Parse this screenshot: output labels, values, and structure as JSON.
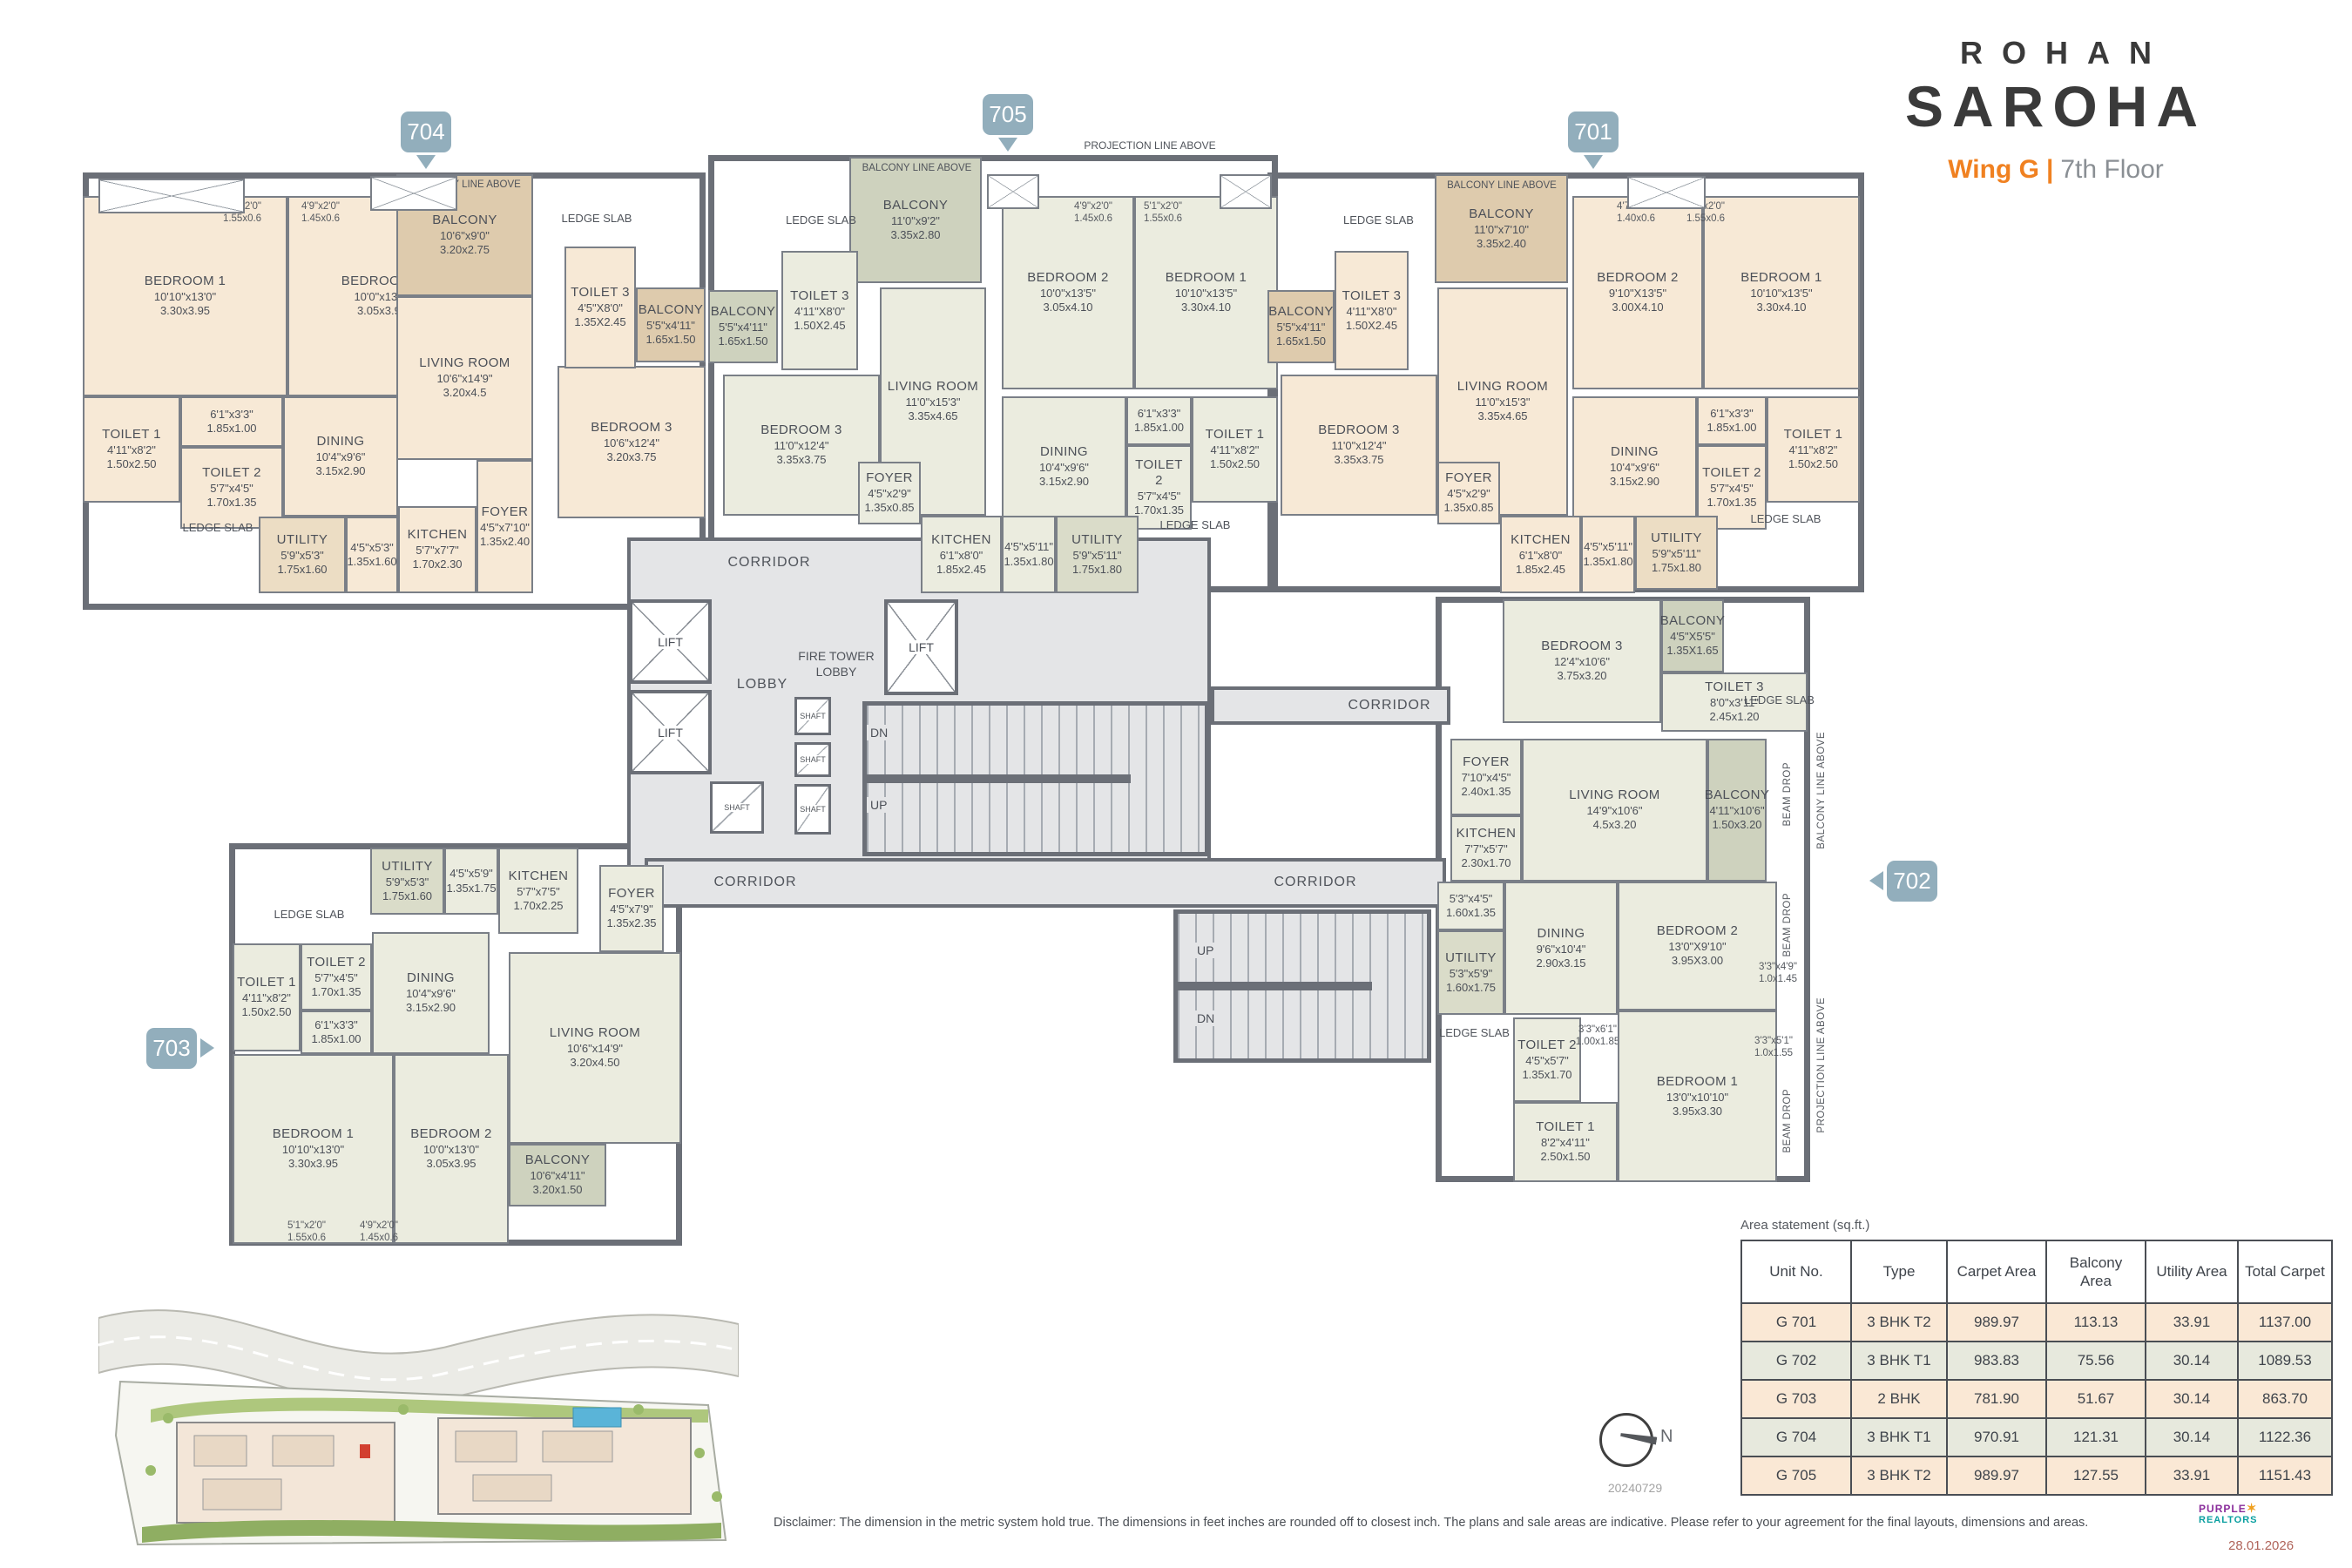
{
  "brand": {
    "line1": "ROHAN",
    "line2": "SAROHA",
    "wing": "Wing G",
    "sep": "|",
    "floor": "7th Floor"
  },
  "colors": {
    "accent": "#f08121",
    "badge": "#92aebc",
    "wall": "#6b6f77",
    "peach": "#f7e9d6",
    "sage": "#ebecdf",
    "tan": "#decbad",
    "corridor": "#e4e5e7",
    "table_row_peach": "#fae8d5",
    "table_row_sage": "#e7e9dd"
  },
  "badges": {
    "u701": "701",
    "u702": "702",
    "u703": "703",
    "u704": "704",
    "u705": "705"
  },
  "labels": {
    "corridor": "CORRIDOR",
    "lobby": "LOBBY",
    "fire_tower_lobby": "FIRE TOWER LOBBY",
    "lift": "LIFT",
    "shaft": "SHAFT",
    "dn": "DN",
    "up": "UP",
    "ledge_slab": "LEDGE SLAB",
    "balcony_line_above": "BALCONY LINE ABOVE",
    "projection_line_above": "PROJECTION LINE ABOVE",
    "beam_drop": "BEAM DROP"
  },
  "rooms": {
    "u704": [
      {
        "name": "BEDROOM 1",
        "ft": "10'10\"x13'0\"",
        "m": "3.30x3.95"
      },
      {
        "name": "BEDROOM 2",
        "ft": "10'0\"x13'0\"",
        "m": "3.05x3.95"
      },
      {
        "name": "BALCONY",
        "ft": "10'6\"x9'0\"",
        "m": "3.20x2.75"
      },
      {
        "name": "LIVING ROOM",
        "ft": "10'6\"x14'9\"",
        "m": "3.20x4.5"
      },
      {
        "name": "TOILET 1",
        "ft": "4'11\"x8'2\"",
        "m": "1.50x2.50"
      },
      {
        "ft": "6'1\"x3'3\"",
        "m": "1.85x1.00"
      },
      {
        "name": "TOILET 2",
        "ft": "5'7\"x4'5\"",
        "m": "1.70x1.35"
      },
      {
        "name": "DINING",
        "ft": "10'4\"x9'6\"",
        "m": "3.15x2.90"
      },
      {
        "name": "UTILITY",
        "ft": "5'9\"x5'3\"",
        "m": "1.75x1.60"
      },
      {
        "ft": "4'5\"x5'3\"",
        "m": "1.35x1.60"
      },
      {
        "name": "KITCHEN",
        "ft": "5'7\"x7'7\"",
        "m": "1.70x2.30"
      },
      {
        "name": "FOYER",
        "ft": "4'5\"x7'10\"",
        "m": "1.35x2.40"
      },
      {
        "name": "BEDROOM 3",
        "ft": "10'6\"x12'4\"",
        "m": "3.20x3.75"
      },
      {
        "name": "TOILET 3",
        "ft": "4'5\"X8'0\"",
        "m": "1.35X2.45"
      },
      {
        "name": "BALCONY",
        "ft": "5'5\"x4'11\"",
        "m": "1.65x1.50"
      },
      {
        "ft": "5'1\"x2'0\"",
        "m": "1.55x0.6"
      },
      {
        "ft": "4'9\"x2'0\"",
        "m": "1.45x0.6"
      }
    ],
    "u705": [
      {
        "name": "BALCONY",
        "ft": "11'0\"x9'2\"",
        "m": "3.35x2.80"
      },
      {
        "name": "LIVING ROOM",
        "ft": "11'0\"x15'3\"",
        "m": "3.35x4.65"
      },
      {
        "name": "BEDROOM 3",
        "ft": "11'0\"x12'4\"",
        "m": "3.35x3.75"
      },
      {
        "name": "BALCONY",
        "ft": "5'5\"x4'11\"",
        "m": "1.65x1.50"
      },
      {
        "name": "TOILET 3",
        "ft": "4'11\"X8'0\"",
        "m": "1.50X2.45"
      },
      {
        "name": "BEDROOM 2",
        "ft": "10'0\"x13'5\"",
        "m": "3.05x4.10"
      },
      {
        "name": "BEDROOM 1",
        "ft": "10'10\"x13'5\"",
        "m": "3.30x4.10"
      },
      {
        "name": "DINING",
        "ft": "10'4\"x9'6\"",
        "m": "3.15x2.90"
      },
      {
        "ft": "6'1\"x3'3\"",
        "m": "1.85x1.00"
      },
      {
        "name": "TOILET 2",
        "ft": "5'7\"x4'5\"",
        "m": "1.70x1.35"
      },
      {
        "name": "TOILET 1",
        "ft": "4'11\"x8'2\"",
        "m": "1.50x2.50"
      },
      {
        "name": "FOYER",
        "ft": "4'5\"x2'9\"",
        "m": "1.35x0.85"
      },
      {
        "name": "KITCHEN",
        "ft": "6'1\"x8'0\"",
        "m": "1.85x2.45"
      },
      {
        "ft": "4'5\"x5'11\"",
        "m": "1.35x1.80"
      },
      {
        "name": "UTILITY",
        "ft": "5'9\"x5'11\"",
        "m": "1.75x1.80"
      },
      {
        "ft": "4'9\"x2'0\"",
        "m": "1.45x0.6"
      },
      {
        "ft": "5'1\"x2'0\"",
        "m": "1.55x0.6"
      }
    ],
    "u701": [
      {
        "name": "BALCONY",
        "ft": "11'0\"x7'10\"",
        "m": "3.35x2.40"
      },
      {
        "name": "LIVING ROOM",
        "ft": "11'0\"x15'3\"",
        "m": "3.35x4.65"
      },
      {
        "name": "BEDROOM 2",
        "ft": "9'10\"X13'5\"",
        "m": "3.00X4.10"
      },
      {
        "name": "BEDROOM 1",
        "ft": "10'10\"x13'5\"",
        "m": "3.30x4.10"
      },
      {
        "name": "DINING",
        "ft": "10'4\"x9'6\"",
        "m": "3.15x2.90"
      },
      {
        "ft": "6'1\"x3'3\"",
        "m": "1.85x1.00"
      },
      {
        "name": "TOILET 2",
        "ft": "5'7\"x4'5\"",
        "m": "1.70x1.35"
      },
      {
        "name": "TOILET 1",
        "ft": "4'11\"x8'2\"",
        "m": "1.50x2.50"
      },
      {
        "name": "FOYER",
        "ft": "4'5\"x2'9\"",
        "m": "1.35x0.85"
      },
      {
        "name": "KITCHEN",
        "ft": "6'1\"x8'0\"",
        "m": "1.85x2.45"
      },
      {
        "ft": "4'5\"x5'11\"",
        "m": "1.35x1.80"
      },
      {
        "name": "UTILITY",
        "ft": "5'9\"x5'11\"",
        "m": "1.75x1.80"
      },
      {
        "name": "BEDROOM 3",
        "ft": "11'0\"x12'4\"",
        "m": "3.35x3.75"
      },
      {
        "name": "TOILET 3",
        "ft": "4'11\"X8'0\"",
        "m": "1.50X2.45"
      },
      {
        "name": "BALCONY",
        "ft": "5'5\"x4'11\"",
        "m": "1.65x1.50"
      },
      {
        "ft": "4'7\"x2'0\"",
        "m": "1.40x0.6"
      },
      {
        "ft": "5'1\"x2'0\"",
        "m": "1.55x0.6"
      }
    ],
    "u702": [
      {
        "name": "BEDROOM 3",
        "ft": "12'4\"x10'6\"",
        "m": "3.75x3.20"
      },
      {
        "name": "BALCONY",
        "ft": "4'5\"X5'5\"",
        "m": "1.35X1.65"
      },
      {
        "name": "TOILET 3",
        "ft": "8'0\"x3'11\"",
        "m": "2.45x1.20"
      },
      {
        "name": "FOYER",
        "ft": "7'10\"x4'5\"",
        "m": "2.40x1.35"
      },
      {
        "name": "LIVING ROOM",
        "ft": "14'9\"x10'6\"",
        "m": "4.5x3.20"
      },
      {
        "name": "KITCHEN",
        "ft": "7'7\"x5'7\"",
        "m": "2.30x1.70"
      },
      {
        "name": "BALCONY",
        "ft": "4'11\"x10'6\"",
        "m": "1.50x3.20"
      },
      {
        "ft": "5'3\"x4'5\"",
        "m": "1.60x1.35"
      },
      {
        "name": "UTILITY",
        "ft": "5'3\"x5'9\"",
        "m": "1.60x1.75"
      },
      {
        "name": "DINING",
        "ft": "9'6\"x10'4\"",
        "m": "2.90x3.15"
      },
      {
        "name": "BEDROOM 2",
        "ft": "13'0\"X9'10\"",
        "m": "3.95X3.00"
      },
      {
        "ft": "3'3\"x4'9\"",
        "m": "1.0x1.45"
      },
      {
        "name": "TOILET 2",
        "ft": "4'5\"x5'7\"",
        "m": "1.35x1.70"
      },
      {
        "ft": "3'3\"x6'1\"",
        "m": "1.00x1.85"
      },
      {
        "name": "TOILET 1",
        "ft": "8'2\"x4'11\"",
        "m": "2.50x1.50"
      },
      {
        "name": "BEDROOM 1",
        "ft": "13'0\"x10'10\"",
        "m": "3.95x3.30"
      },
      {
        "ft": "3'3\"x5'1\"",
        "m": "1.0x1.55"
      }
    ],
    "u703": [
      {
        "name": "UTILITY",
        "ft": "5'9\"x5'3\"",
        "m": "1.75x1.60"
      },
      {
        "ft": "4'5\"x5'9\"",
        "m": "1.35x1.75"
      },
      {
        "name": "KITCHEN",
        "ft": "5'7\"x7'5\"",
        "m": "1.70x2.25"
      },
      {
        "name": "FOYER",
        "ft": "4'5\"x7'9\"",
        "m": "1.35x2.35"
      },
      {
        "name": "TOILET 1",
        "ft": "4'11\"x8'2\"",
        "m": "1.50x2.50"
      },
      {
        "name": "TOILET 2",
        "ft": "5'7\"x4'5\"",
        "m": "1.70x1.35"
      },
      {
        "ft": "6'1\"x3'3\"",
        "m": "1.85x1.00"
      },
      {
        "name": "DINING",
        "ft": "10'4\"x9'6\"",
        "m": "3.15x2.90"
      },
      {
        "name": "LIVING ROOM",
        "ft": "10'6\"x14'9\"",
        "m": "3.20x4.50"
      },
      {
        "name": "BEDROOM 1",
        "ft": "10'10\"x13'0\"",
        "m": "3.30x3.95"
      },
      {
        "name": "BEDROOM 2",
        "ft": "10'0\"x13'0\"",
        "m": "3.05x3.95"
      },
      {
        "name": "BALCONY",
        "ft": "10'6\"x4'11\"",
        "m": "3.20x1.50"
      },
      {
        "ft": "5'1\"x2'0\"",
        "m": "1.55x0.6"
      },
      {
        "ft": "4'9\"x2'0\"",
        "m": "1.45x0.6"
      }
    ]
  },
  "area_table": {
    "title": "Area statement (sq.ft.)",
    "headers": [
      "Unit No.",
      "Type",
      "Carpet Area",
      "Balcony Area",
      "Utility Area",
      "Total Carpet"
    ],
    "rows": [
      [
        "G  701",
        "3 BHK T2",
        "989.97",
        "113.13",
        "33.91",
        "1137.00"
      ],
      [
        "G  702",
        "3 BHK T1",
        "983.83",
        "75.56",
        "30.14",
        "1089.53"
      ],
      [
        "G  703",
        "2 BHK",
        "781.90",
        "51.67",
        "30.14",
        "863.70"
      ],
      [
        "G  704",
        "3 BHK T1",
        "970.91",
        "121.31",
        "30.14",
        "1122.36"
      ],
      [
        "G  705",
        "3 BHK T2",
        "989.97",
        "127.55",
        "33.91",
        "1151.43"
      ]
    ]
  },
  "compass": {
    "n": "N",
    "code": "20240729"
  },
  "footer": {
    "disclaimer": "Disclaimer: The dimension in the metric system hold true. The dimensions in feet inches are rounded off to closest inch. The plans and sale areas are indicative. Please refer to your agreement for the final layouts, dimensions and areas.",
    "logo_line1": "PURPLE",
    "logo_line2": "REALTORS",
    "date": "28.01.2026"
  }
}
